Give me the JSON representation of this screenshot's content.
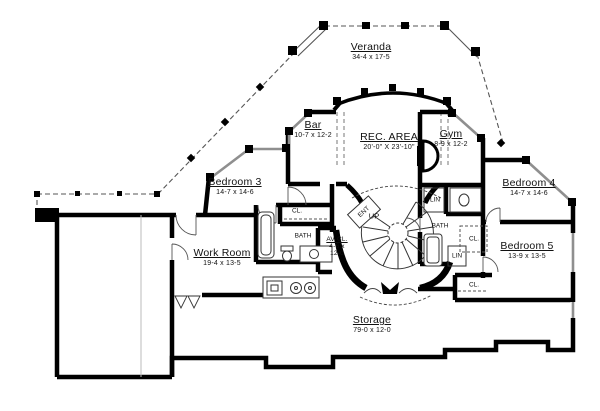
{
  "title": "Basement floor plan",
  "colors": {
    "wall": "#000000",
    "window": "#8f8f8f",
    "railing": "#555555",
    "background": "#ffffff",
    "text": "#111111"
  },
  "rooms": {
    "veranda": {
      "name": "Veranda",
      "dims": "34-4 x 17-5"
    },
    "bar": {
      "name": "Bar",
      "dims": "10-7 x 12-2"
    },
    "rec_area": {
      "name": "REC. AREA",
      "dims": "20'-0\" X 23'-10\""
    },
    "gym": {
      "name": "Gym",
      "dims": "8-9 x 12-2"
    },
    "bedroom3": {
      "name": "Bedroom 3",
      "dims": "14-7 x 14-6"
    },
    "bedroom4": {
      "name": "Bedroom 4",
      "dims": "14-7 x 14-6"
    },
    "bedroom5": {
      "name": "Bedroom 5",
      "dims": "13-9 x 13-5"
    },
    "work_room": {
      "name": "Work Room",
      "dims": "19-4 x 13-5"
    },
    "storage": {
      "name": "Storage",
      "dims": "79-0 x 12-0"
    },
    "av_closet": {
      "name": "AV CL.",
      "dims_line1": "4-6 x",
      "dims_line2": "12-0"
    }
  },
  "labels": {
    "bath_left": "BATH",
    "closet_bath_left": "CL.",
    "bath_right": "BATH",
    "linen_top": "LIN",
    "linen_bottom": "LIN",
    "closet_bath_right": "CL.",
    "closet_bedroom5": "CL.",
    "stair_up": "UP",
    "entry": "ENT"
  }
}
